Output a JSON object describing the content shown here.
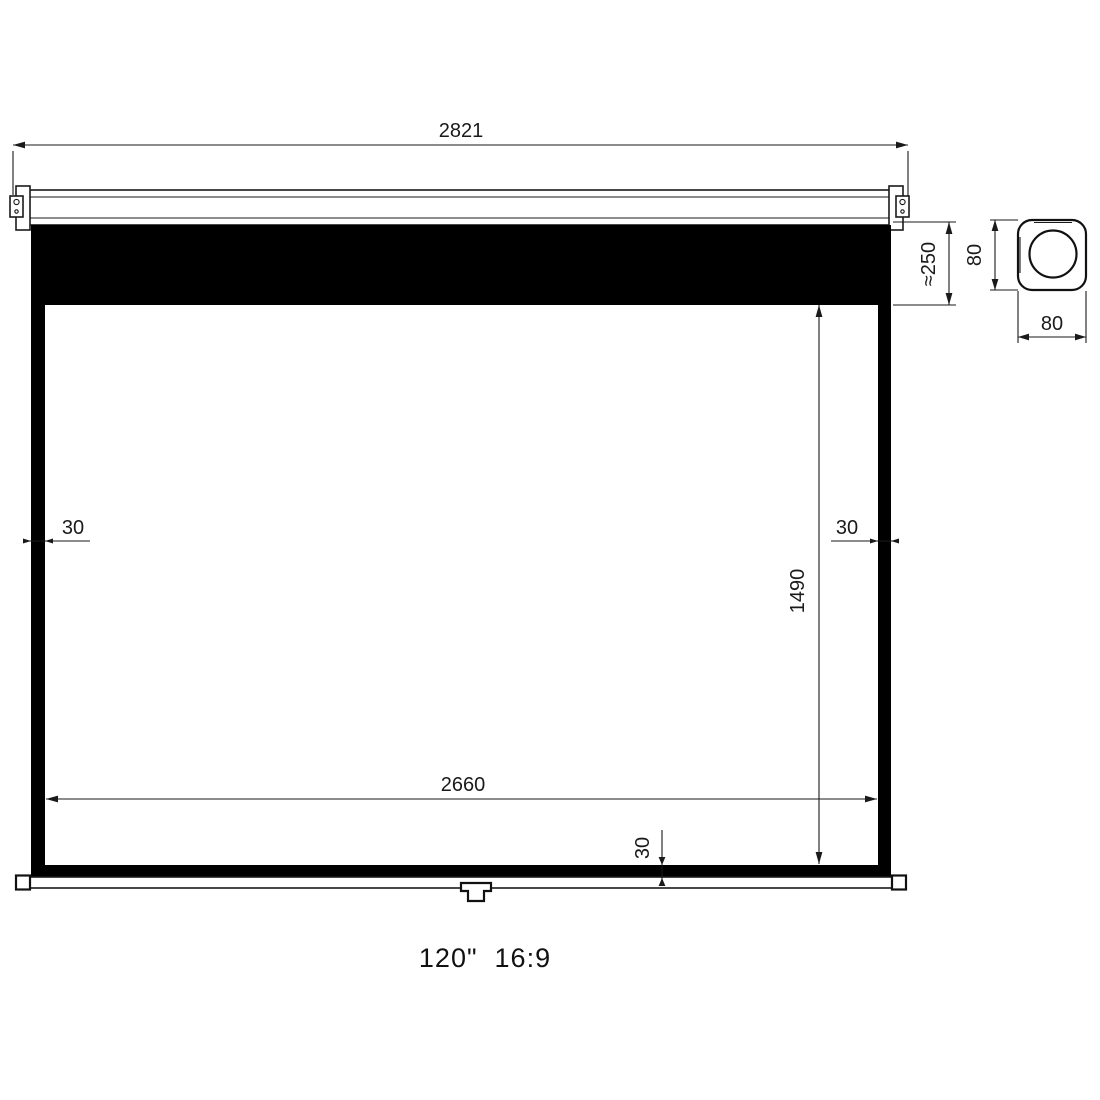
{
  "colors": {
    "line": "#1a1a1a",
    "screen_frame": "#000000",
    "background": "#ffffff"
  },
  "dimensions": {
    "overall_width": "2821",
    "top_drop": "≈250",
    "case_height": "80",
    "case_depth": "80",
    "left_border": "30",
    "right_border": "30",
    "viewing_height": "1490",
    "viewing_width": "2660",
    "bottom_border": "30"
  },
  "caption": {
    "text": "120\"  16:9"
  }
}
